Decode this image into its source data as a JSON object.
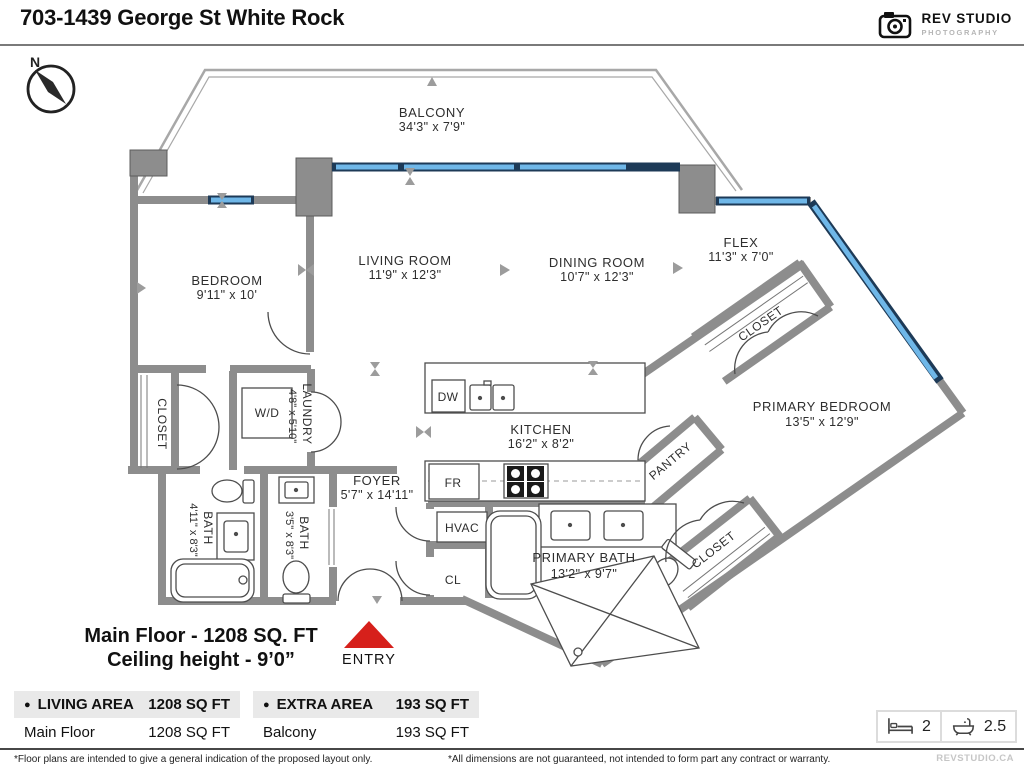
{
  "header": {
    "title": "703-1439 George St White Rock",
    "logo_name": "REV STUDIO",
    "logo_sub": "PHOTOGRAPHY"
  },
  "compass": {
    "north": "N"
  },
  "plan": {
    "balcony_name": "BALCONY",
    "balcony_dims": "34'3\" x 7'9\"",
    "bedroom_name": "BEDROOM",
    "bedroom_dims": "9'11\" x 10'",
    "living_name": "LIVING ROOM",
    "living_dims": "11'9\" x 12'3\"",
    "dining_name": "DINING ROOM",
    "dining_dims": "10'7\" x 12'3\"",
    "flex_name": "FLEX",
    "flex_dims": "11'3\" x 7'0\"",
    "kitchen_name": "KITCHEN",
    "kitchen_dims": "16'2\" x 8'2\"",
    "foyer_name": "FOYER",
    "foyer_dims": "5'7\" x 14'11\"",
    "laundry_name": "LAUNDRY",
    "laundry_dims": "4'8\" x 5'10\"",
    "bath1_name": "BATH",
    "bath1_dims": "4'11\" x 8'3\"",
    "bath2_name": "BATH",
    "bath2_dims": "3'5\" x 8'3\"",
    "pbath_name": "PRIMARY BATH",
    "pbath_dims": "13'2\" x 9'7\"",
    "pbed_name": "PRIMARY BEDROOM",
    "pbed_dims": "13'5\" x 12'9\"",
    "closet_bedroom": "CLOSET",
    "closet_upper": "CLOSET",
    "closet_primary": "CLOSET",
    "pantry": "PANTRY",
    "wd": "W/D",
    "dw": "DW",
    "fr": "FR",
    "hvac": "HVAC",
    "cl": "CL",
    "entry": "ENTRY",
    "summary1": "Main Floor - 1208 SQ. FT",
    "summary2": "Ceiling height - 9’0”"
  },
  "tables": [
    {
      "bullet": "●",
      "label": "LIVING AREA",
      "value": "1208 SQ FT",
      "rows": [
        {
          "label": "Main Floor",
          "value": "1208 SQ FT"
        }
      ]
    },
    {
      "bullet": "●",
      "label": "EXTRA AREA",
      "value": "193 SQ FT",
      "rows": [
        {
          "label": "Balcony",
          "value": "193 SQ FT"
        }
      ]
    }
  ],
  "stats": {
    "beds": "2",
    "baths": "2.5"
  },
  "footer": {
    "left": "*Floor plans are intended to give a general indication of the proposed layout only.",
    "right": "*All dimensions are not guaranteed, not intended to form part any contract or warranty.",
    "site": "REVSTUDIO.CA"
  },
  "colors": {
    "wall": "#8d8d8d",
    "window": "#6fb7e8",
    "window_frame": "#1d3a57",
    "entry_red": "#d6201b"
  }
}
